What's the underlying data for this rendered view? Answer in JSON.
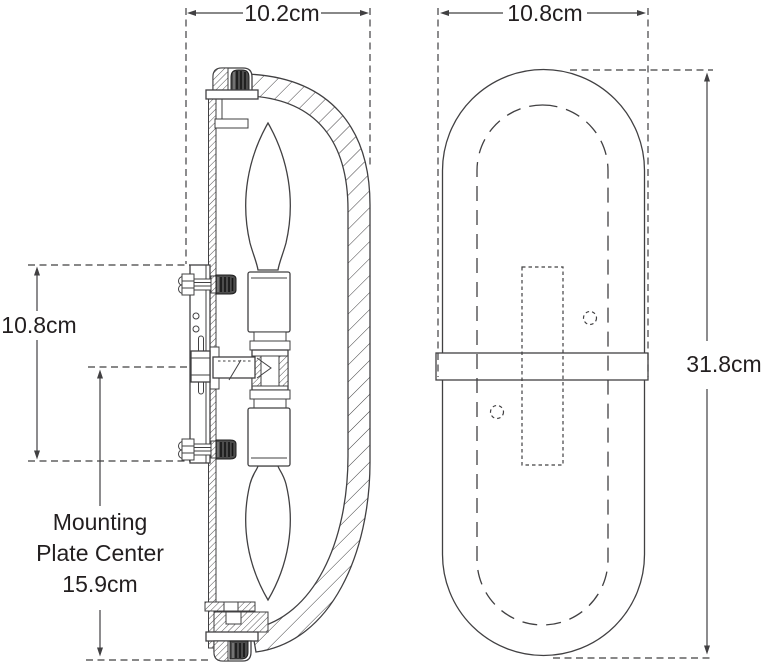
{
  "drawing": {
    "colors": {
      "line": "#414042",
      "text": "#231f20",
      "knob_fill": "#4d4d4d",
      "background": "#ffffff"
    },
    "side_view": {
      "width_label": "10.2cm",
      "backplate_height_label": "10.8cm",
      "mounting_note_line1": "Mounting",
      "mounting_note_line2": "Plate Center",
      "mounting_note_line3": "15.9cm"
    },
    "front_view": {
      "width_label": "10.8cm",
      "height_label": "31.8cm"
    }
  }
}
